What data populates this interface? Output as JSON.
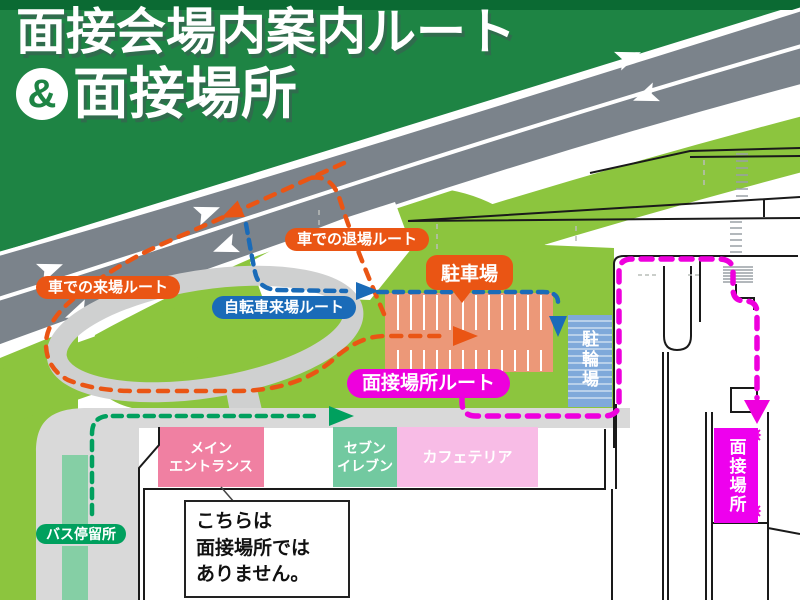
{
  "title": {
    "line1": "面接会場内案内ルート",
    "ampersand": "&",
    "line2": "面接場所"
  },
  "routes": {
    "car_arrival": {
      "label": "車での来場ルート",
      "color": "#ea5514"
    },
    "car_exit": {
      "label": "車での退場ルート",
      "color": "#ea5514"
    },
    "bicycle": {
      "label": "自転車来場ルート",
      "color": "#1a6bb8"
    },
    "interview": {
      "label": "面接場所ルート",
      "color": "#ee00dd"
    },
    "bus_stop": {
      "label": "バス停留所",
      "color": "#00a05e"
    }
  },
  "places": {
    "parking": {
      "label": "駐車場",
      "color": "#ea5514"
    },
    "bicycle_parking": {
      "label": "駐輪場",
      "color": "#7fa9da"
    },
    "interview_location": {
      "label": "面接場所",
      "color": "#ee00ee"
    },
    "main_entrance": {
      "line1": "メイン",
      "line2": "エントランス",
      "color": "#f080a2"
    },
    "seven_eleven": {
      "line1": "セブン",
      "line2": "イレブン",
      "color": "#72c9a0"
    },
    "cafeteria": {
      "label": "カフェテリア",
      "color": "#f8bce6"
    }
  },
  "callout": {
    "line1": "こちらは",
    "line2": "面接場所では",
    "line3": "ありません。"
  },
  "colors": {
    "header_green": "#1e8444",
    "header_dark": "#0b6a33",
    "road_gray": "#7b838b",
    "grass_green": "#8cc53e",
    "mint_green": "#85cfa5",
    "plaza_gray": "#d9d9d9",
    "parking_salmon": "#ec9878"
  }
}
